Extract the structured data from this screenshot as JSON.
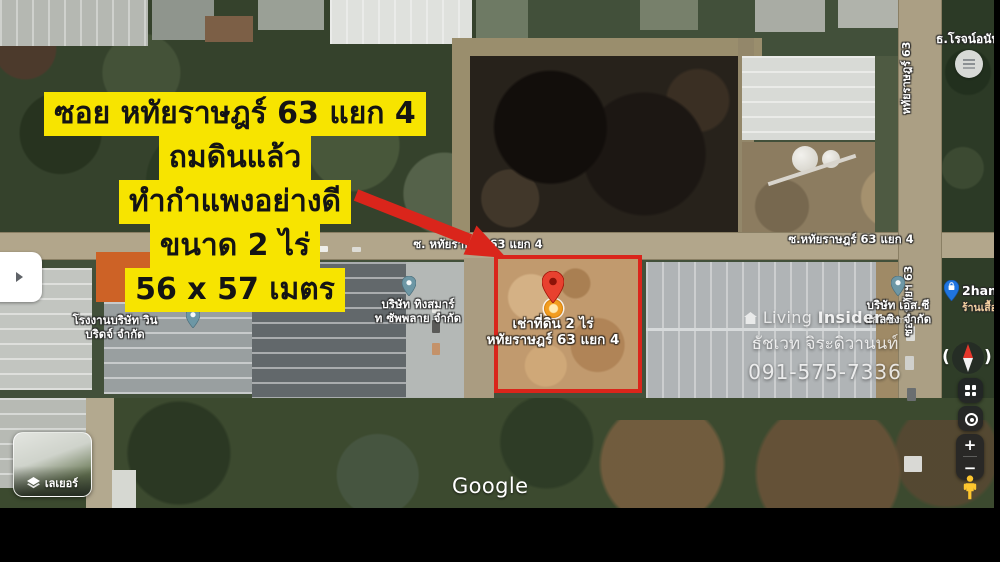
{
  "overlay": {
    "lines": [
      "ซอย หทัยราษฎร์ 63 แยก 4",
      "ถมดินแล้ว",
      "ทำกำแพงอย่างดี",
      "ขนาด 2 ไร่",
      "56 x 57 เมตร"
    ],
    "highlight_color": "#f7e400",
    "text_color": "#141414",
    "arrow_color": "#da251b"
  },
  "plot": {
    "outline_color": "#da251b",
    "label_line1": "เช่าที่ดิน 2 ไร่",
    "label_line2": "หทัยราษฎร์ 63 แยก 4",
    "pin_color": "#e8412f",
    "pin_disc_color": "#f29d20"
  },
  "roads": {
    "left": "ซ. หทัยราษฎร์ 63 แยก 4",
    "right": "ซ.หทัยราษฎร์ 63 แยก 4",
    "vertical_top": "หทัยราษฎร์ 63",
    "vertical_mid": "ซอย หทัยฯ 63"
  },
  "pois": {
    "bank": "ธ.โรจน์อนัน",
    "factory_line1": "โรงงานบริษัท วิน",
    "factory_line2": "บริดจ์ จำกัด",
    "supply_line1": "บริษัท ทิงสมาร์",
    "supply_line2": "ท ซัพพลาย จำกัด",
    "glazing_line1": "บริษัท เอส.ซี",
    "glazing_line2": "แกลซิง จำกัด",
    "shop_name": "2han",
    "shop_sub": "ร้านเสื้อ",
    "pin_color": "#6d97a5",
    "shop_pin_color": "#1f74e0"
  },
  "watermark": {
    "brand_light": "Living",
    "brand_bold": "Insider",
    "brand_suffix": ".com",
    "agent_name": "ธัชเวท จิระดิวานนท์",
    "phone": "091-575-7336"
  },
  "attribution": {
    "logo": "Google"
  },
  "controls": {
    "layers_label": "เลเยอร์",
    "zoom_in": "+",
    "zoom_out": "−",
    "compass_left": "(",
    "compass_right": ")"
  }
}
